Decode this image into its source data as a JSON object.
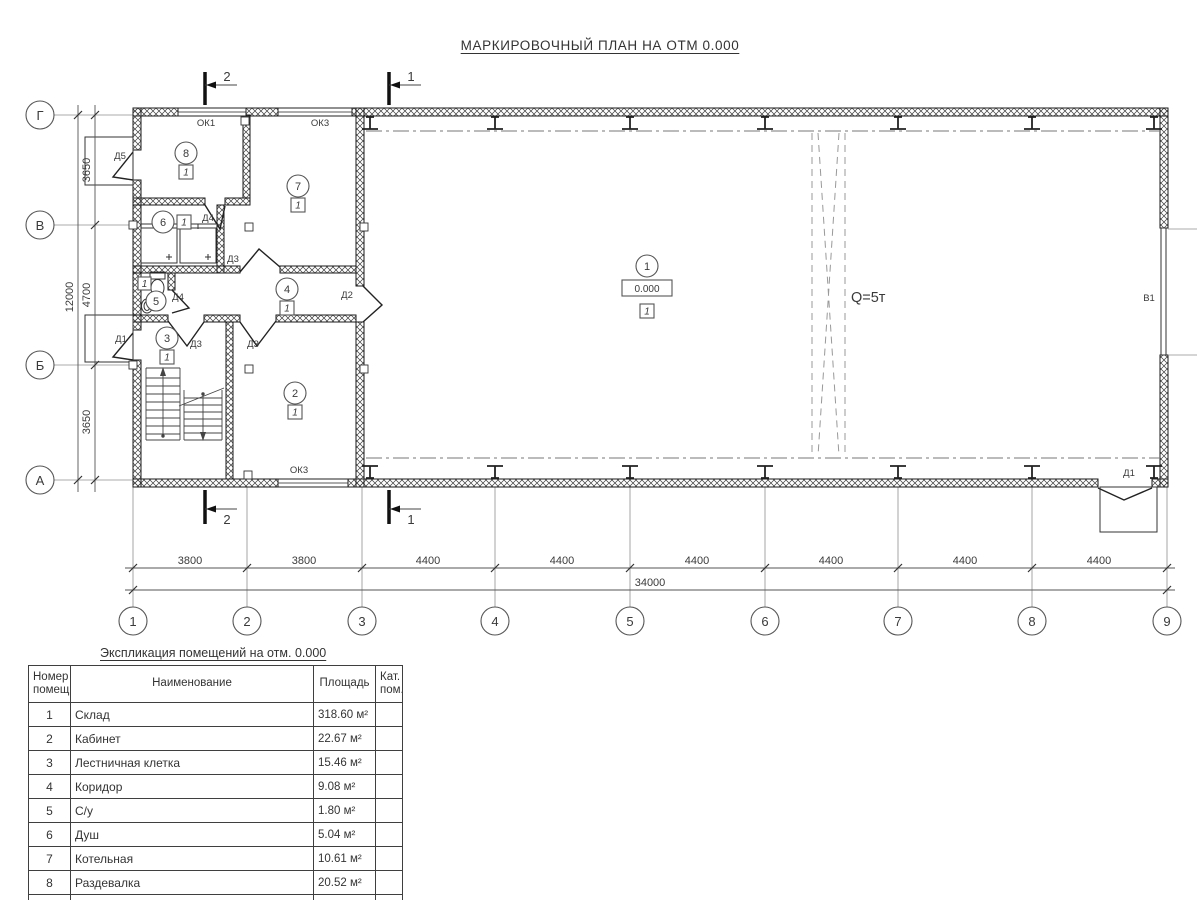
{
  "title": "МАРКИРОВОЧНЫЙ ПЛАН НА ОТМ 0.000",
  "plan": {
    "elevation": "0.000",
    "floor_mark": "1",
    "crane": "Q=5т",
    "gate": "В1",
    "room_numbers": [
      "1",
      "2",
      "3",
      "4",
      "5",
      "6",
      "7",
      "8"
    ],
    "doors": {
      "d1": "Д1",
      "d2": "Д2",
      "d3": "Д3",
      "d4": "Д4",
      "d5": "Д5"
    },
    "windows": {
      "ok1": "ОК1",
      "ok3": "ОК3"
    },
    "sections": {
      "s1": "1",
      "s2": "2"
    }
  },
  "axes": {
    "rows": [
      "Г",
      "В",
      "Б",
      "А"
    ],
    "cols": [
      "1",
      "2",
      "3",
      "4",
      "5",
      "6",
      "7",
      "8",
      "9"
    ],
    "row_dims": [
      "3650",
      "4700",
      "3650"
    ],
    "row_total": "12000",
    "col_dims": [
      "3800",
      "3800",
      "4400",
      "4400",
      "4400",
      "4400",
      "4400",
      "4400"
    ],
    "col_total": "34000"
  },
  "schedule": {
    "caption": "Экспликация помещений на отм. 0.000",
    "headers": {
      "num": "Номер помещ.",
      "name": "Наименование",
      "area": "Площадь",
      "cat": "Кат. пом."
    },
    "rows": [
      {
        "num": "1",
        "name": "Склад",
        "area": "318.60 м²"
      },
      {
        "num": "2",
        "name": "Кабинет",
        "area": "22.67 м²"
      },
      {
        "num": "3",
        "name": "Лестничная клетка",
        "area": "15.46 м²"
      },
      {
        "num": "4",
        "name": "Коридор",
        "area": "9.08 м²"
      },
      {
        "num": "5",
        "name": "С/у",
        "area": "1.80 м²"
      },
      {
        "num": "6",
        "name": "Душ",
        "area": "5.04 м²"
      },
      {
        "num": "7",
        "name": "Котельная",
        "area": "10.61 м²"
      },
      {
        "num": "8",
        "name": "Раздевалка",
        "area": "20.52 м²"
      }
    ],
    "total_label": "ИТОГО:",
    "total_area": "403.78 м²"
  }
}
